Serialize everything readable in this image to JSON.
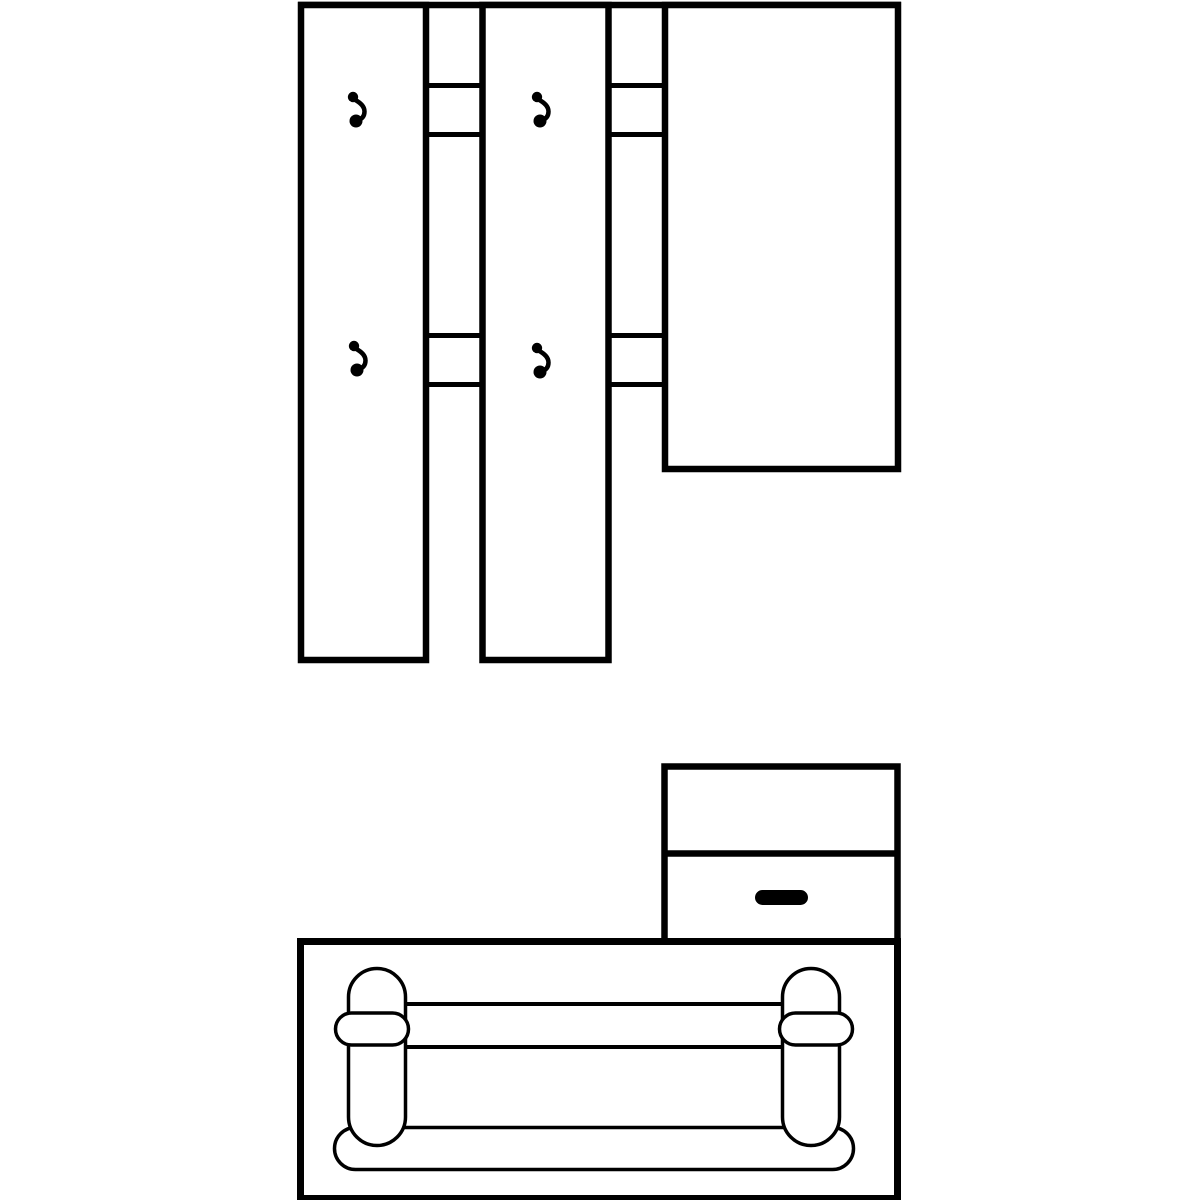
{
  "image": {
    "type": "line-drawing",
    "subject": "hallway furniture set",
    "style": "black outlines on white background"
  },
  "colors": {
    "line": "#000000",
    "background": "#ffffff"
  },
  "wall_unit": {
    "coat_panels": 2,
    "hooks_total": 4,
    "hooks_per_panel": 2,
    "connector_rails": 4,
    "mirror_panels": 1
  },
  "cabinet": {
    "compartments": 2,
    "drawer_handles": 1,
    "handle_shape": "pill"
  },
  "bench": {
    "side_supports": 2,
    "cross_straps": 2,
    "shoe_rails": 2,
    "base": "rounded bar"
  }
}
